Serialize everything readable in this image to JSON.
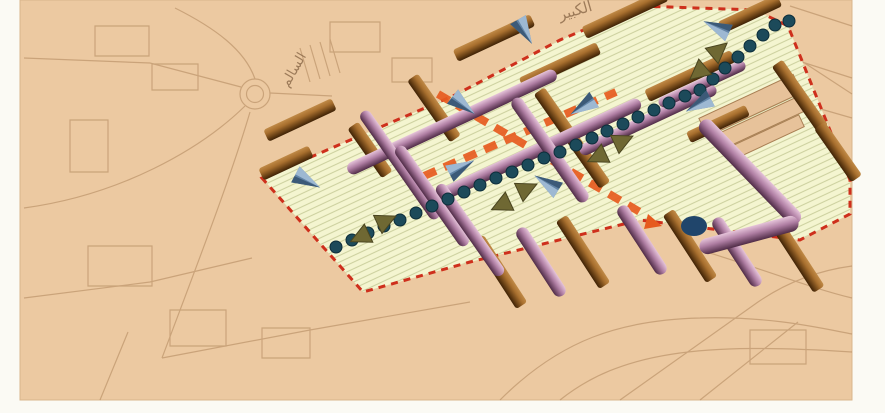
{
  "colors": {
    "page_bg": "#fbfaf4",
    "map_base": "#ecc9a1",
    "map_edge": "#d9b58c",
    "sketch": "#a97f54",
    "district_fill": "#f4f5d0",
    "district_hatch": "#cdd1a0",
    "boundary_red": "#ce2f1c",
    "axis_orange": "#e65a1e",
    "dot_fill": "#1c4a5a",
    "dot_edge": "#0c2d3a",
    "brown_hi": "#c08a47",
    "brown_mid": "#a86f2e",
    "brown_lo": "#3f2205",
    "purple_hi": "#e6c4da",
    "purple_mid": "#b07fa4",
    "purple_lo": "#4f2b46",
    "cone_light": "#9db8d2",
    "cone_mid": "#6284a6",
    "cone_dark": "#3c5a78",
    "olive": "#6f6833",
    "olive_dark": "#4a4520",
    "dome_navy": "#20456b",
    "plinth_fill": "#e7c29a",
    "plinth_line": "#a97f54",
    "label_ink": "#8a6848"
  },
  "map": {
    "labels": [
      {
        "text": "الكبير"
      },
      {
        "text": "السالم"
      }
    ]
  }
}
